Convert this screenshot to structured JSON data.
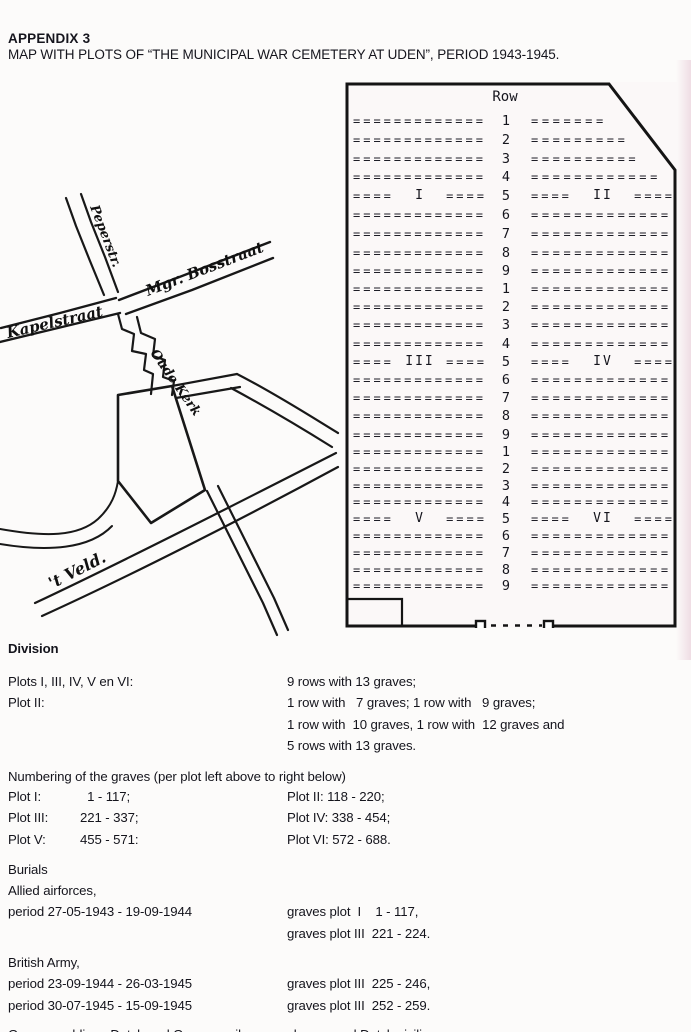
{
  "page": {
    "appendix": "APPENDIX 3",
    "title": "MAP WITH PLOTS OF “THE MUNICIPAL WAR CEMETERY AT UDEN”, PERIOD 1943-1945."
  },
  "map": {
    "labels": {
      "peperstraat": "Peperstr.",
      "bosstraat": "Mgr. Bosstraat",
      "kapelstraat": "Kapelstraat",
      "oudekerk": "Oude Kerk",
      "veld": "'t Veld."
    }
  },
  "diagram": {
    "row_header": "Row",
    "grave_symbol": "=",
    "label_flank": "====",
    "groups": [
      {
        "left_label": "I",
        "right_label": "II",
        "label_row": 5,
        "rows": [
          [
            1,
            13,
            7
          ],
          [
            2,
            13,
            9
          ],
          [
            3,
            13,
            10
          ],
          [
            4,
            13,
            12
          ],
          [
            5,
            13,
            13
          ],
          [
            6,
            13,
            13
          ],
          [
            7,
            13,
            13
          ],
          [
            8,
            13,
            13
          ],
          [
            9,
            13,
            13
          ]
        ]
      },
      {
        "left_label": "III",
        "right_label": "IV",
        "label_row": 5,
        "rows": [
          [
            1,
            13,
            13
          ],
          [
            2,
            13,
            13
          ],
          [
            3,
            13,
            13
          ],
          [
            4,
            13,
            13
          ],
          [
            5,
            13,
            13
          ],
          [
            6,
            13,
            13
          ],
          [
            7,
            13,
            13
          ],
          [
            8,
            13,
            13
          ],
          [
            9,
            13,
            13
          ]
        ]
      },
      {
        "left_label": "V",
        "right_label": "VI",
        "label_row": 5,
        "rows": [
          [
            1,
            13,
            13
          ],
          [
            2,
            13,
            13
          ],
          [
            3,
            13,
            13
          ],
          [
            4,
            13,
            13
          ],
          [
            5,
            13,
            13
          ],
          [
            6,
            13,
            13
          ],
          [
            7,
            13,
            13
          ],
          [
            8,
            13,
            13
          ],
          [
            9,
            13,
            13
          ]
        ]
      }
    ]
  },
  "division": {
    "heading": "Division",
    "rows": [
      {
        "left": "Plots I, III, IV, V en VI:",
        "right": "9 rows with 13 graves;"
      },
      {
        "left": "Plot II:",
        "right": "1 row with   7 graves; 1 row with   9 graves;"
      },
      {
        "left": "",
        "right": "1 row with  10 graves, 1 row with  12 graves and"
      },
      {
        "left": "",
        "right": "5 rows with 13 graves."
      }
    ]
  },
  "numbering": {
    "heading": "Numbering of the graves (per plot left above to right below)",
    "rows": [
      {
        "left_label": "Plot I:",
        "left_range": "  1 - 117;",
        "right": "Plot II: 118 - 220;"
      },
      {
        "left_label": "Plot III:",
        "left_range": "221 - 337;",
        "right": "Plot IV: 338 - 454;"
      },
      {
        "left_label": "Plot V:",
        "left_range": "455 - 571:",
        "right": "Plot VI: 572 - 688."
      }
    ]
  },
  "burials": {
    "heading": "Burials",
    "entries": [
      {
        "intro": "Allied airforces,",
        "rows": [
          {
            "left": "period 27-05-1943 - 19-09-1944",
            "right": "graves plot  I    1 - 117,"
          },
          {
            "left": "",
            "right": "graves plot III  221 - 224."
          }
        ]
      },
      {
        "intro": "British Army,",
        "rows": [
          {
            "left": "period 23-09-1944 - 26-03-1945",
            "right": "graves plot III  225 - 246,"
          },
          {
            "left": "period 30-07-1945 - 15-09-1945",
            "right": "graves plot III  252 - 259."
          }
        ]
      },
      {
        "intro": "German soldiers, Dutch and German railway-employees and Dutch civilian,",
        "rows": [
          {
            "left": "period  8-03-1944 -  4-12-1944",
            "right": "graves plot  II  118 - 126."
          }
        ]
      }
    ]
  }
}
